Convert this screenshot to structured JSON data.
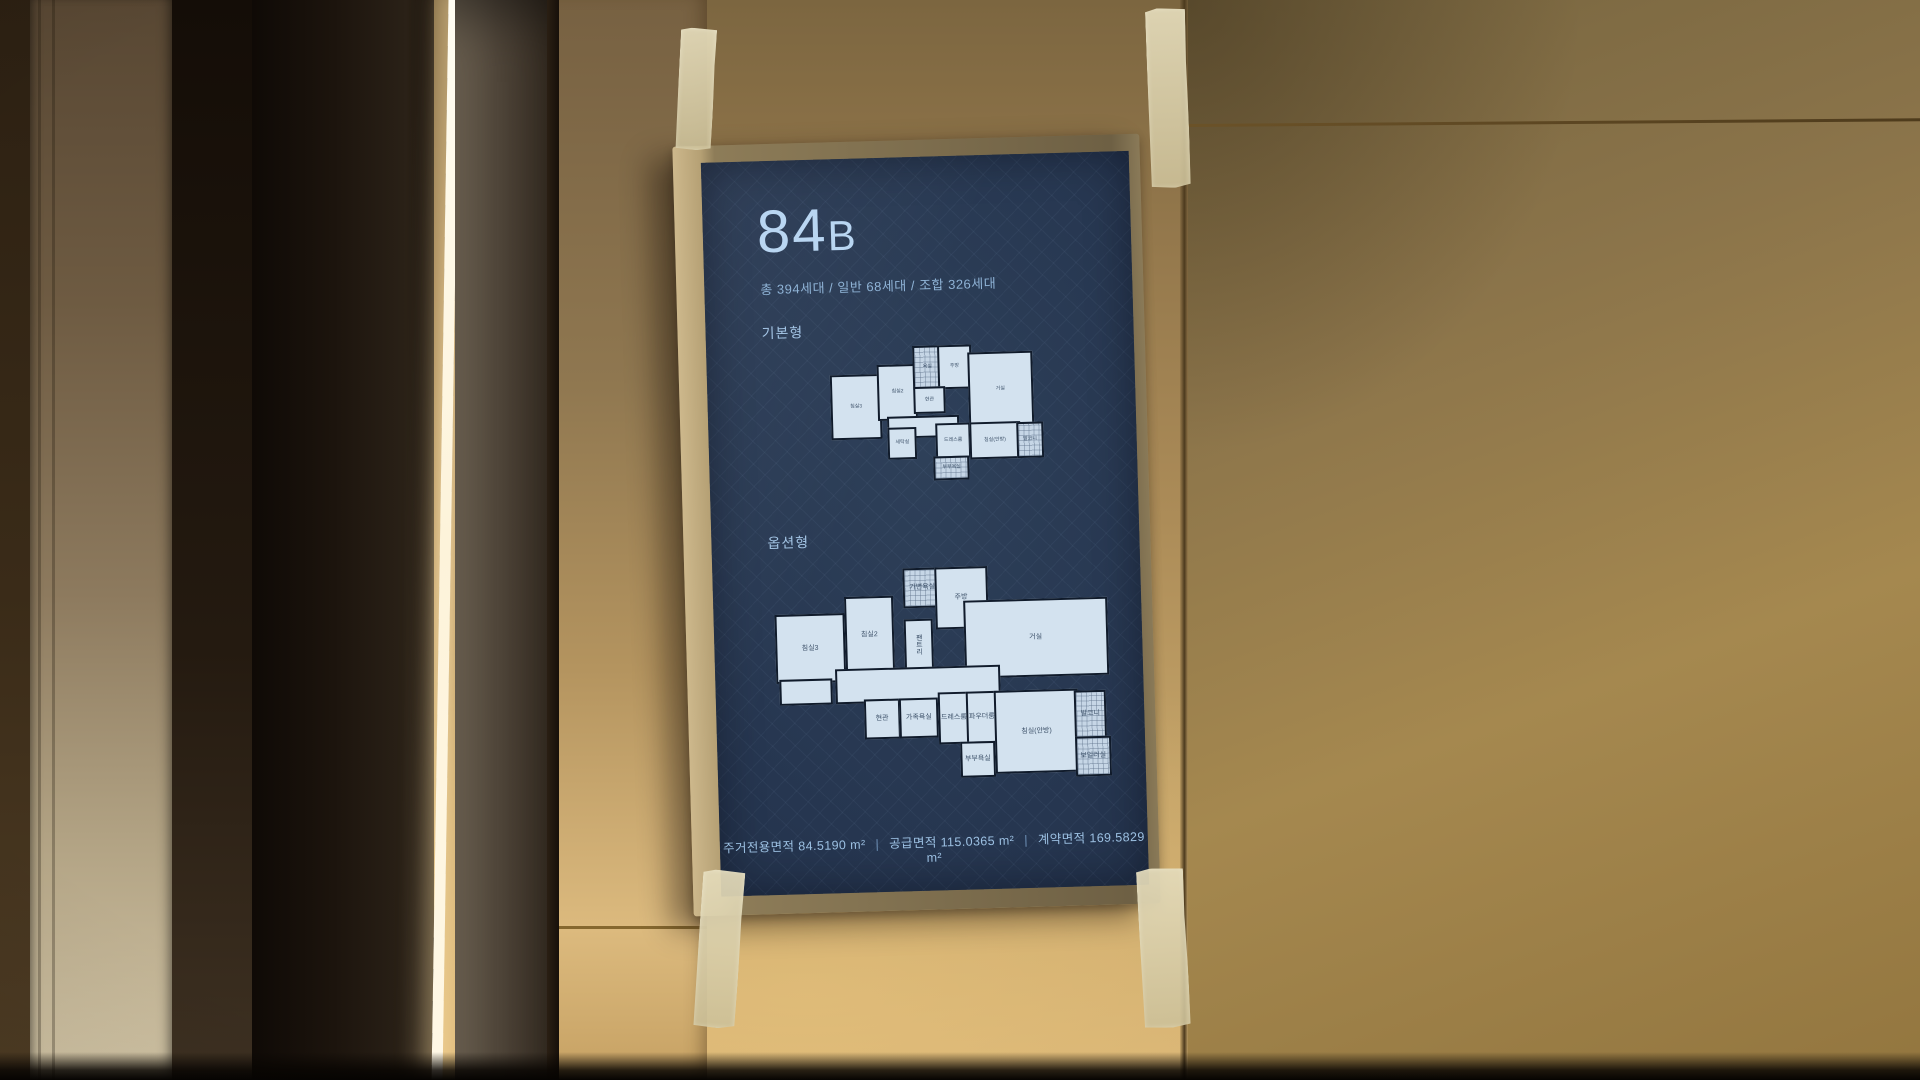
{
  "poster": {
    "unit_number": "84",
    "unit_suffix": "B",
    "household_info": "총 394세대 / 일반 68세대 / 조합 326세대",
    "sections": {
      "basic": "기본형",
      "option": "옵션형"
    },
    "area_items": [
      {
        "text": "주거전용면적 84.5190 m²"
      },
      {
        "text": "공급면적 115.0365 m²"
      },
      {
        "text": "계약면적 169.5829 m²"
      }
    ],
    "area_separator": "|",
    "colors": {
      "screen_navy": "#2a3a54",
      "title_blue": "#b9d6f2",
      "body_blue": "#8fb3d6",
      "plan_fill": "#d3e2ef",
      "plan_wall": "#101b2b",
      "wall_gold": "#c3a267",
      "tape_beige": "#d9d0ab",
      "led_white": "#fdf6e4"
    },
    "plans": {
      "basic": {
        "rooms": [
          {
            "label": "침실3"
          },
          {
            "label": "침실2"
          },
          {
            "label": "욕실"
          },
          {
            "label": "주방"
          },
          {
            "label": "현관"
          },
          {
            "label": "거실"
          },
          {
            "label": "세탁실"
          },
          {
            "label": "드레스룸"
          },
          {
            "label": "침실(안방)"
          },
          {
            "label": "발코니"
          },
          {
            "label": "부부욕실"
          }
        ]
      },
      "option": {
        "rooms": [
          {
            "label": "침실3"
          },
          {
            "label": "침실2"
          },
          {
            "label": "가변욕실"
          },
          {
            "label": "팬트리"
          },
          {
            "label": "주방"
          },
          {
            "label": "거실"
          },
          {
            "label": "현관"
          },
          {
            "label": "가족욕실"
          },
          {
            "label": "드레스룸"
          },
          {
            "label": "파우더룸"
          },
          {
            "label": "부부욕실"
          },
          {
            "label": "침실(안방)"
          },
          {
            "label": "발코니"
          },
          {
            "label": "보일러실"
          }
        ]
      }
    }
  }
}
